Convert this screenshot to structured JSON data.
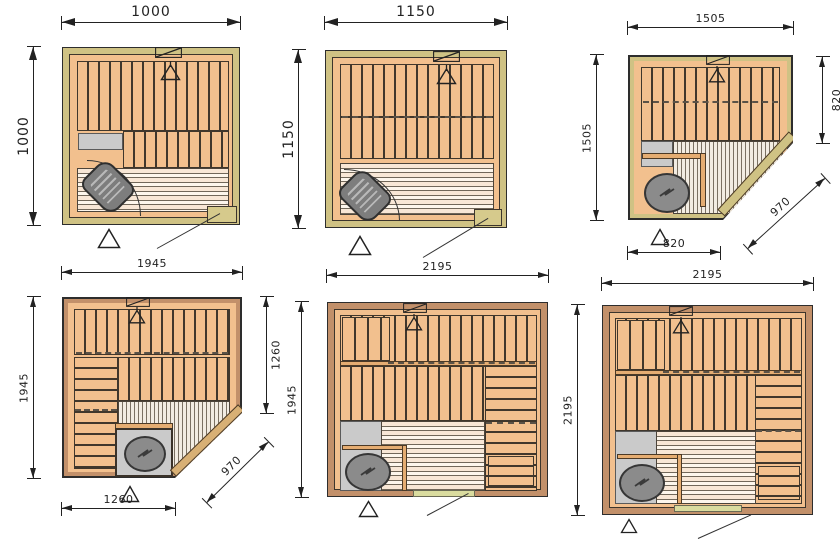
{
  "drawing": {
    "colors": {
      "background": "#ffffff",
      "wall_khaki": "#cfc284",
      "wall_brown": "#c2906a",
      "wood_plank": "#f2c08e",
      "floor_stripe": "#f8e7d6",
      "gray_area": "#cacaca",
      "heater_gray": "#8b8b8b",
      "door_green": "#dadc9f",
      "line_dark": "#222222"
    },
    "plans": [
      {
        "dims": {
          "top": "1000",
          "left": "1000"
        }
      },
      {
        "dims": {
          "top": "1150",
          "left": "1150"
        }
      },
      {
        "dims": {
          "top": "1505",
          "left": "1505",
          "right": "820",
          "diagonal": "970",
          "bottom": "820"
        }
      },
      {
        "dims": {
          "top": "1945",
          "left": "1945",
          "right": "1260",
          "diagonal": "970",
          "bottom": "1260"
        }
      },
      {
        "dims": {
          "top": "2195",
          "left": "1945"
        }
      },
      {
        "dims": {
          "top": "2195",
          "left": "2195"
        }
      }
    ]
  }
}
